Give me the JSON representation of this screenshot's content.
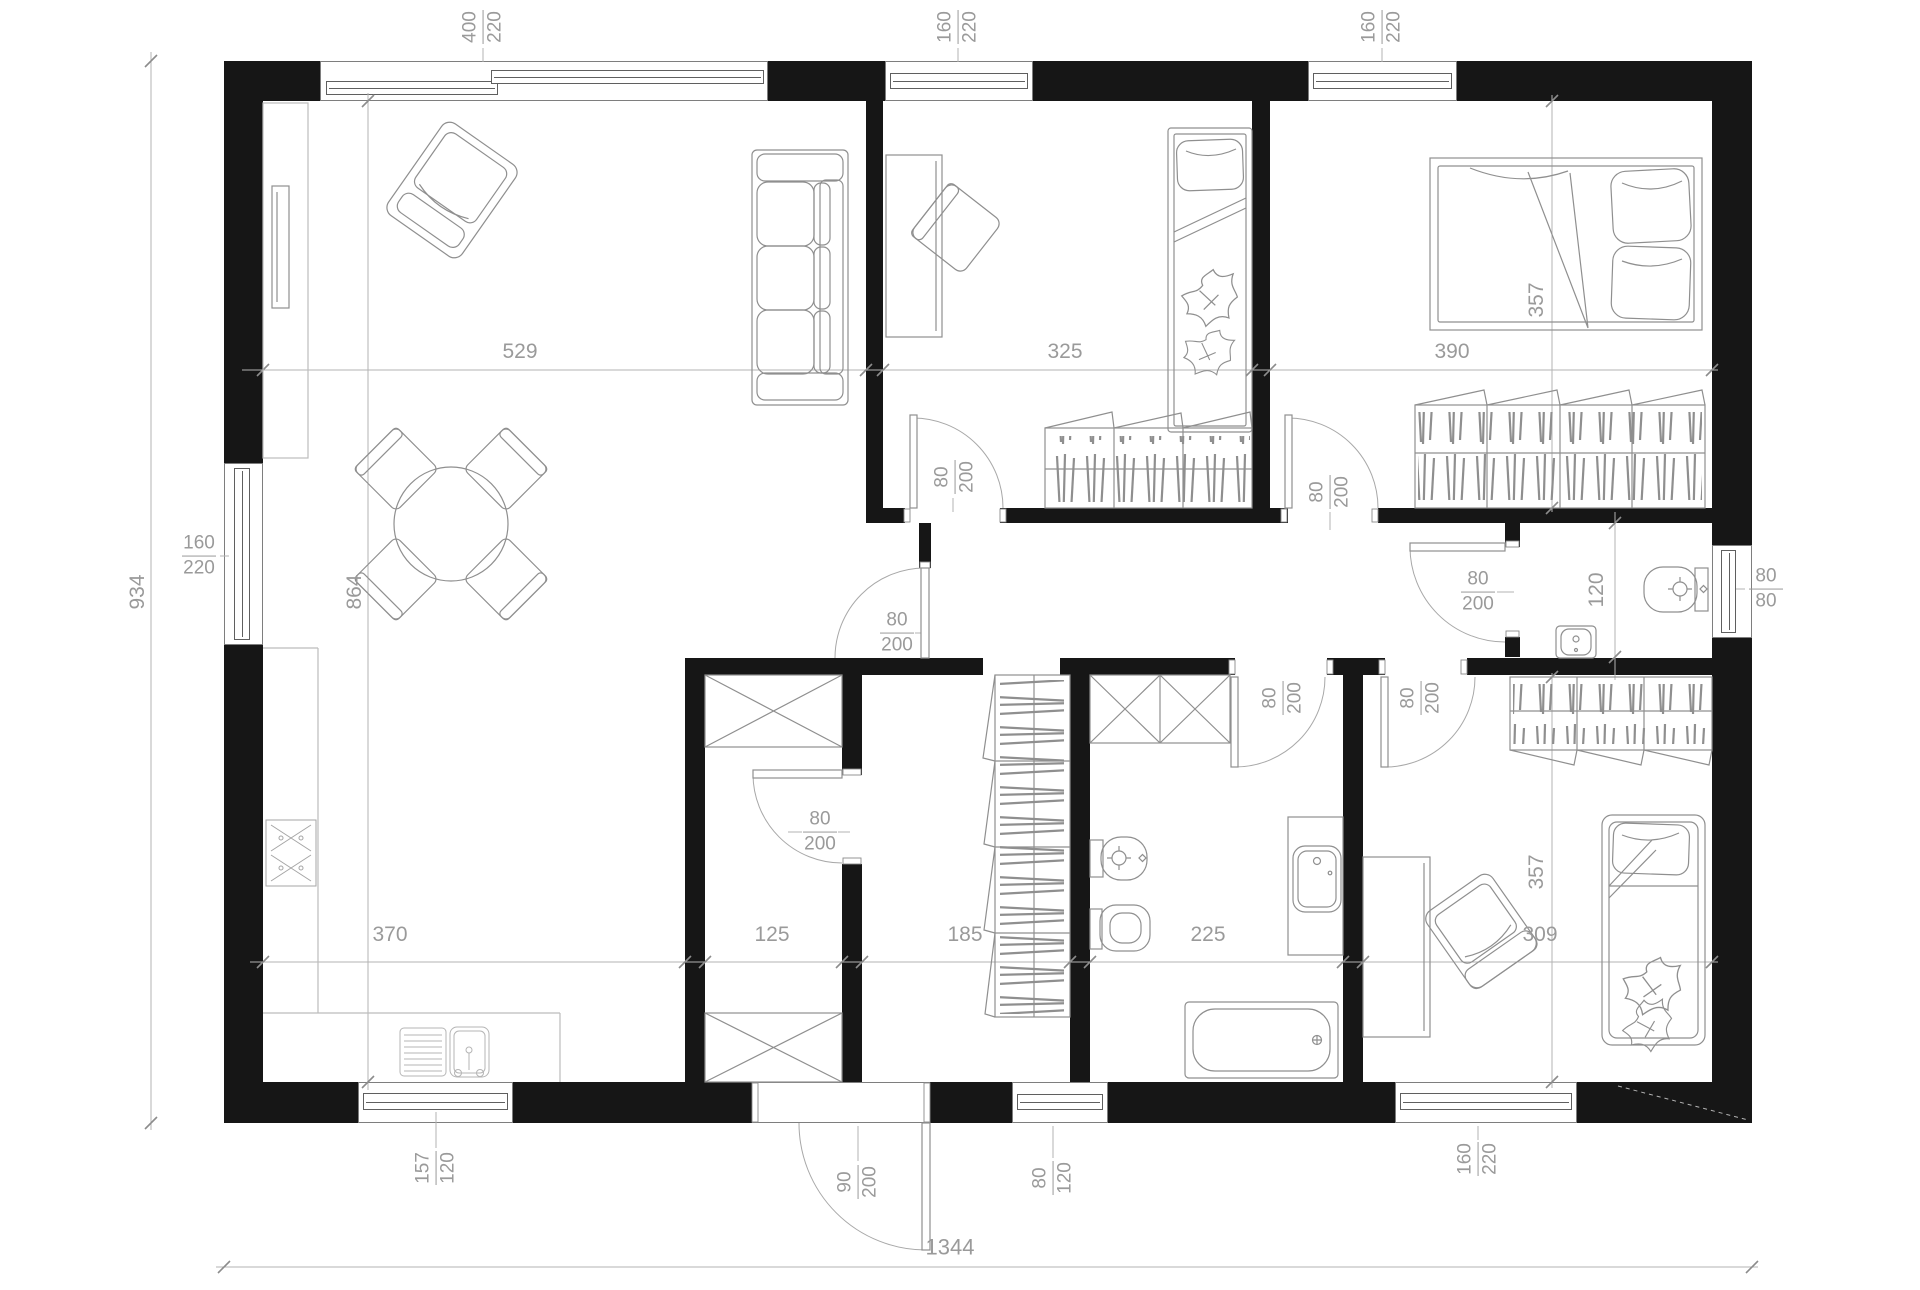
{
  "plan": {
    "overall_width": "1344",
    "overall_depth": "934",
    "interior_depth": "864"
  },
  "rooms": {
    "living": {
      "width": "529"
    },
    "child_bedroom": {
      "width": "325"
    },
    "master_bedroom": {
      "width": "390",
      "depth": "357"
    },
    "kitchen": {
      "width": "370"
    },
    "storage": {
      "width": "125"
    },
    "hall": {
      "width": "185"
    },
    "bathroom": {
      "width": "225"
    },
    "bedroom2": {
      "width": "309",
      "depth": "357"
    },
    "wc": {
      "depth": "120"
    }
  },
  "windows": {
    "living_top": {
      "w": "400",
      "h": "220"
    },
    "child_top": {
      "w": "160",
      "h": "220"
    },
    "master_top": {
      "w": "160",
      "h": "220"
    },
    "living_left": {
      "w": "160",
      "h": "220"
    },
    "kitchen_bottom": {
      "w": "157",
      "h": "120"
    },
    "hall_bottom": {
      "w": "80",
      "h": "120"
    },
    "bedroom2_bottom": {
      "w": "160",
      "h": "220"
    },
    "wc_right": {
      "w": "80",
      "h": "80"
    }
  },
  "doors": {
    "child": {
      "w": "80",
      "h": "200"
    },
    "master": {
      "w": "80",
      "h": "200"
    },
    "corridor": {
      "w": "80",
      "h": "200"
    },
    "storage": {
      "w": "80",
      "h": "200"
    },
    "bathroom": {
      "w": "80",
      "h": "200"
    },
    "bedroom2": {
      "w": "80",
      "h": "200"
    },
    "wc": {
      "w": "80",
      "h": "200"
    },
    "entrance": {
      "w": "90",
      "h": "200"
    }
  }
}
